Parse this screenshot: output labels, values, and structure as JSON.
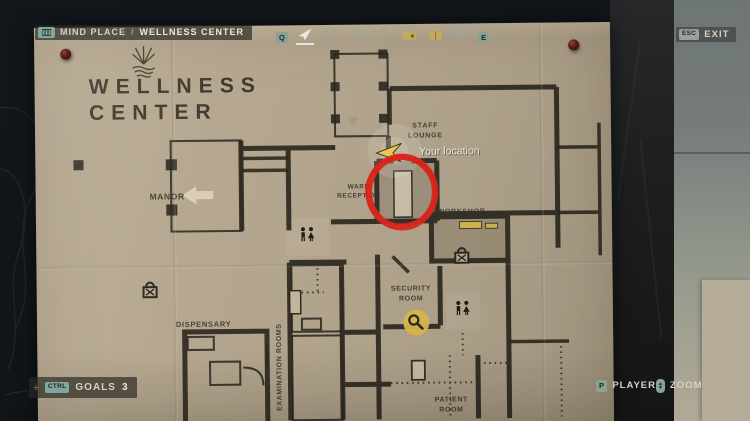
{
  "header": {
    "breadcrumb": {
      "key_icon": "map-icon",
      "location": "MIND PLACE",
      "separator": "/",
      "sublocation": "WELLNESS CENTER"
    },
    "tabs": {
      "prev_key": "Q",
      "next_key": "E",
      "selected": "map",
      "items": [
        "map",
        "case-file",
        "manuscript",
        "globe",
        "evidence-folder",
        "inventory-box",
        "weapon"
      ]
    },
    "exit": {
      "key": "ESC",
      "label": "EXIT"
    }
  },
  "map": {
    "title": {
      "line1": "WELLNESS",
      "line2": "CENTER"
    },
    "labels": {
      "manor": "MANOR",
      "staff_lounge1": "STAFF",
      "staff_lounge2": "LOUNGE",
      "ward_reception1": "WARD",
      "ward_reception2": "RECEPTION",
      "workshop": "WORKSHOP",
      "security1": "SECURITY",
      "security2": "ROOM",
      "dispensary": "DISPENSARY",
      "examination": "EXAMINATION ROOMS",
      "patient1": "PATIENT",
      "patient2": "ROOM",
      "your_location": "Your location"
    },
    "icons": [
      "padlock-icon",
      "padlock-icon",
      "magnifier-poi-icon",
      "restroom-icon",
      "restroom-icon",
      "player-arrow-icon",
      "objective-circle"
    ]
  },
  "footer": {
    "goals": {
      "key": "CTRL",
      "label": "GOALS",
      "count": "3"
    },
    "player": {
      "key": "P",
      "label": "PLAYER"
    },
    "zoom": {
      "key_icon": "mouse-wheel",
      "label": "ZOOM"
    }
  },
  "colors": {
    "paper": "#b6a890",
    "wall": "#2e2a21",
    "accent_red": "#e1261c",
    "accent_yellow": "#dfbe4e",
    "badge_green": "#8aa296",
    "text_light": "#eceadf"
  }
}
